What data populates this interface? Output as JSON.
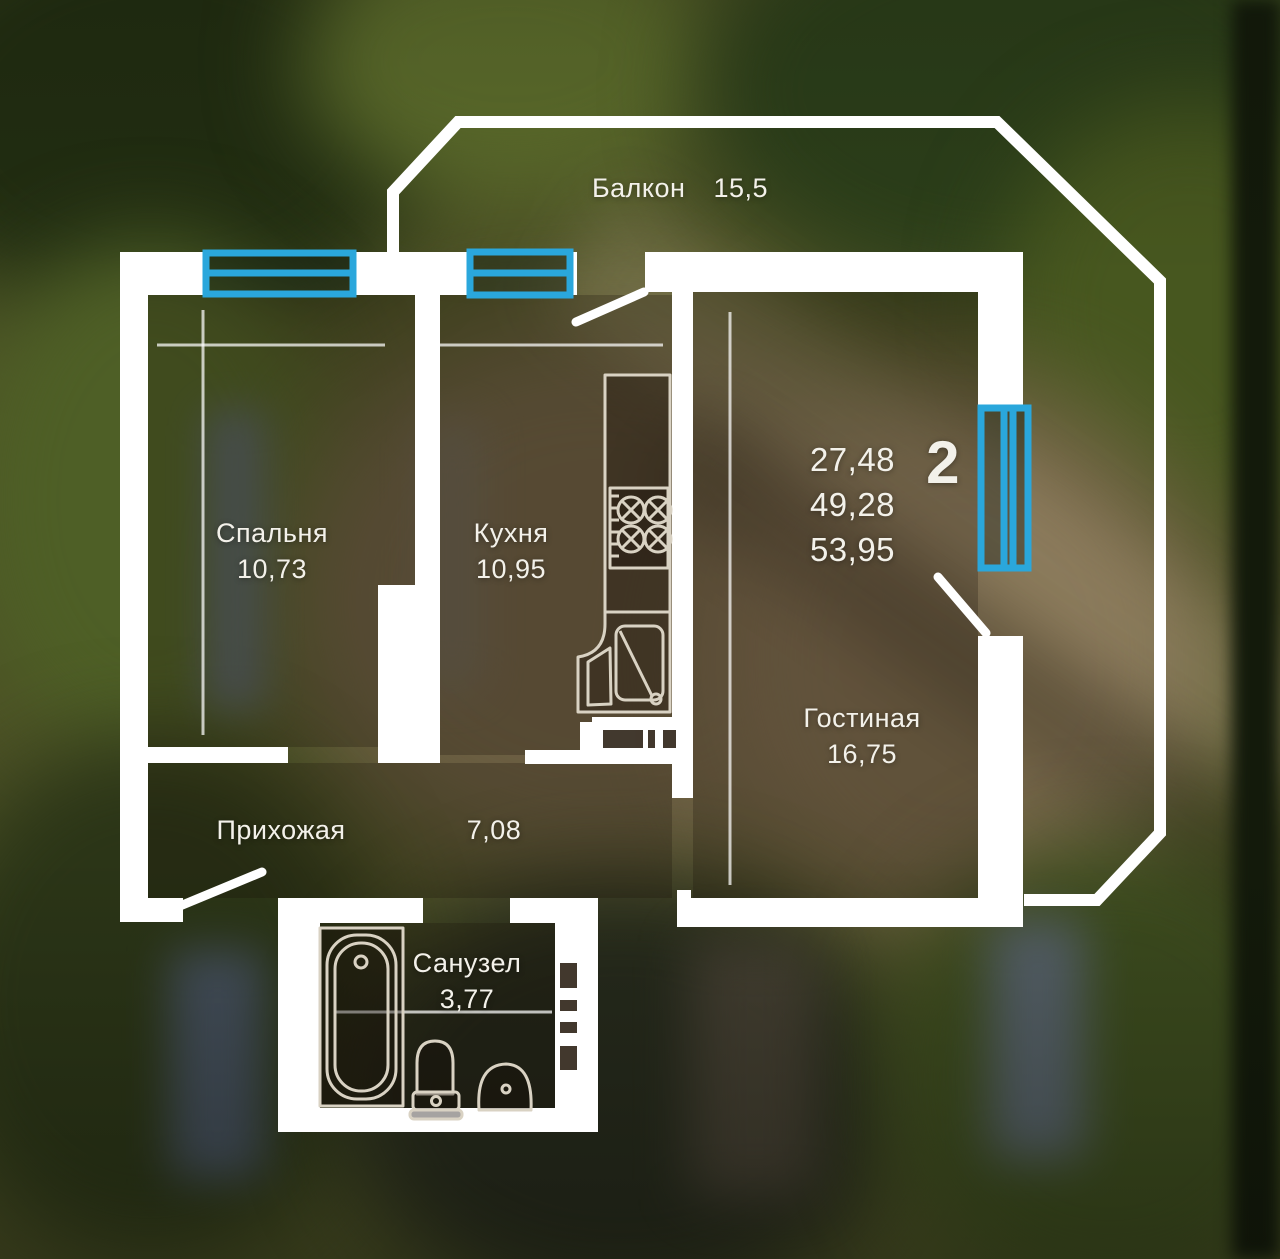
{
  "plan": {
    "balcony": {
      "label": "Балкон",
      "area": "15,5"
    },
    "bedroom": {
      "label": "Спальня",
      "area": "10,73"
    },
    "kitchen": {
      "label": "Кухня",
      "area": "10,95"
    },
    "living": {
      "label": "Гостиная",
      "area": "16,75"
    },
    "hallway": {
      "label": "Прихожая",
      "area": "7,08"
    },
    "bathroom": {
      "label": "Санузел",
      "area": "3,77"
    },
    "summary": {
      "rooms": "2",
      "areas": [
        "27,48",
        "49,28",
        "53,95"
      ]
    },
    "colors": {
      "wall": "#ffffff",
      "window_frame": "#2aa7dc",
      "fixture_line": "#d9d2c3"
    }
  }
}
